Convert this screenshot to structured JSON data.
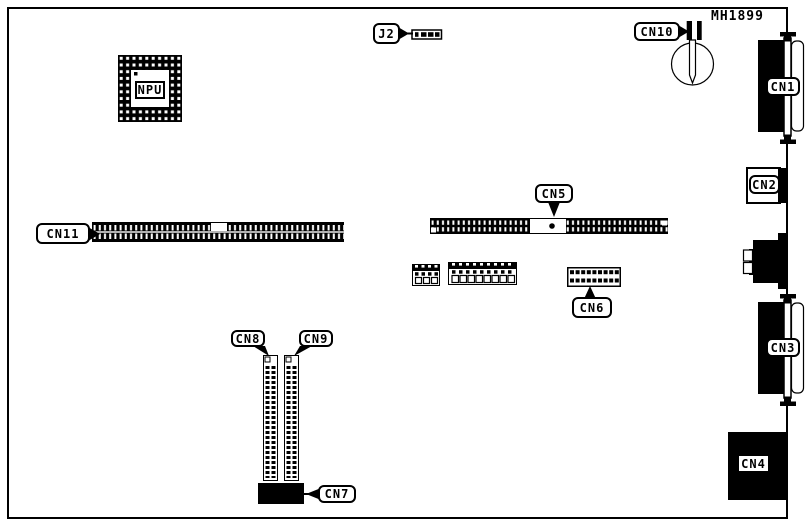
{
  "window": {
    "background": "#ffffff",
    "ink": "#000000",
    "description": "Motherboard connector location diagram"
  },
  "board": {
    "chip_label": "NPU",
    "part_number": "MH1899",
    "callouts": {
      "j2": "J2",
      "cn1": "CN1",
      "cn2": "CN2",
      "cn3": "CN3",
      "cn4": "CN4",
      "cn5": "CN5",
      "cn6": "CN6",
      "cn7": "CN7",
      "cn8": "CN8",
      "cn9": "CN9",
      "cn10": "CN10",
      "cn11": "CN11"
    }
  }
}
